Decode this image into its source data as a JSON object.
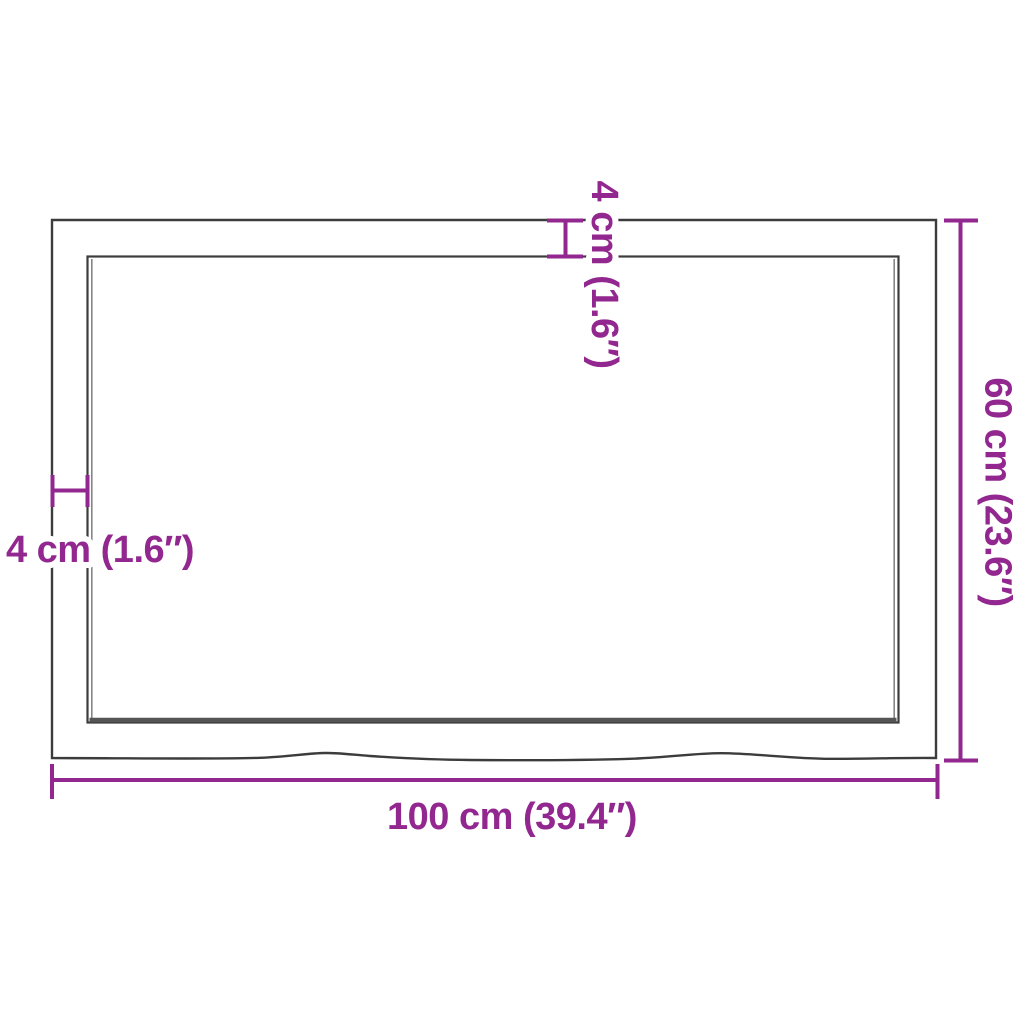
{
  "diagram": {
    "kind": "product-dimension-diagram",
    "subject": "tabletop-top-view",
    "colors": {
      "dimension_accent": "#92278F",
      "outline": "#3C3C3C",
      "edge_shadow": "#555555",
      "background": "#FFFFFF"
    },
    "dimensions": {
      "width": {
        "cm": 100,
        "inches": 39.4,
        "label": "100 cm (39.4″)"
      },
      "depth": {
        "cm": 60,
        "inches": 23.6,
        "label": "60 cm (23.6″)"
      },
      "edge_top": {
        "cm": 4,
        "inches": 1.6,
        "label": "4 cm (1.6″)"
      },
      "edge_left": {
        "cm": 4,
        "inches": 1.6,
        "label": "4 cm (1.6″)"
      }
    }
  }
}
